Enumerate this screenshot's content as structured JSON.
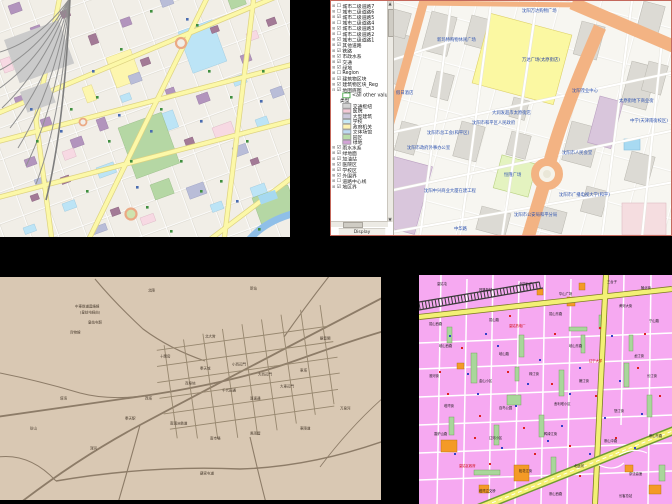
{
  "palette": {
    "desktop_background": "#000000",
    "gis_window_border": "#c4685c"
  },
  "osm_map": {
    "palette": {
      "background": "#f1eee7",
      "road_major": "#fcf8a8",
      "road_casing": "#ddd280",
      "minor_street": "#ffffff",
      "water": "#8fbfe8",
      "park": "#b5d7a4",
      "building_cyan": "#bce4f6",
      "building_purple": "#b294bd",
      "building_maroon": "#a37a96",
      "building_yellow": "#fdf6ae",
      "railway": "#909090",
      "roundabout_ring": "#eba984",
      "poi_green": "#3f8f3f",
      "poi_blue": "#4a6cb0"
    }
  },
  "gis_window": {
    "toc": {
      "layers_top": [
        {
          "e": "⊞",
          "b": "☐",
          "label": "城市二级道路7"
        },
        {
          "e": "⊞",
          "b": "☐",
          "label": "城市二级道路6"
        },
        {
          "e": "⊞",
          "b": "☑",
          "label": "城市二级道路5"
        },
        {
          "e": "⊞",
          "b": "☐",
          "label": "城市二级道路4"
        },
        {
          "e": "⊞",
          "b": "☑",
          "label": "城市二级道路3"
        },
        {
          "e": "⊞",
          "b": "☐",
          "label": "城市二级道路2"
        },
        {
          "e": "⊞",
          "b": "☑",
          "label": "城市二级道路1"
        },
        {
          "e": "⊞",
          "b": "☑",
          "label": "其他道路"
        },
        {
          "e": "⊞",
          "b": "☑",
          "label": "铁路"
        },
        {
          "e": "⊞",
          "b": "☑",
          "label": "市政水系"
        },
        {
          "e": "⊞",
          "b": "☑",
          "label": "交通"
        },
        {
          "e": "⊞",
          "b": "☑",
          "label": "绿地"
        },
        {
          "e": "⊞",
          "b": "☐",
          "label": "Region"
        },
        {
          "e": "⊞",
          "b": "☑",
          "label": "建筑物区块"
        },
        {
          "e": "⊞",
          "b": "☑",
          "label": "建筑物区块_Reg"
        },
        {
          "e": "⊟",
          "b": "☑",
          "label": "地图底图"
        }
      ],
      "legend": {
        "all_other": "<all other values>",
        "header": "类型",
        "items": [
          {
            "color": "#d2d2d2",
            "label": "交通枢纽"
          },
          {
            "color": "#f5c9d6",
            "label": "医院"
          },
          {
            "color": "#ccc9dc",
            "label": "大型建筑"
          },
          {
            "color": "#c6e9f6",
            "label": "学校"
          },
          {
            "color": "#fdf2b3",
            "label": "政府机关"
          },
          {
            "color": "#bedaf2",
            "label": "文体场馆"
          },
          {
            "color": "#b9dcaa",
            "label": "园区"
          },
          {
            "color": "#d3a3d6",
            "label": "绿地"
          }
        ]
      },
      "layers_bottom": [
        {
          "e": "⊞",
          "b": "☑",
          "label": "雨水水系"
        },
        {
          "e": "⊞",
          "b": "☑",
          "label": "绿地面"
        },
        {
          "e": "⊞",
          "b": "☑",
          "label": "加油站"
        },
        {
          "e": "⊞",
          "b": "☑",
          "label": "医院区"
        },
        {
          "e": "⊞",
          "b": "☑",
          "label": "学校区"
        },
        {
          "e": "⊞",
          "b": "☑",
          "label": "外围界"
        },
        {
          "e": "⊞",
          "b": "☐",
          "label": "道路中心线"
        },
        {
          "e": "⊞",
          "b": "☑",
          "label": "地区界"
        }
      ],
      "tab": "Display"
    },
    "map_labels": [
      {
        "x": 128,
        "y": 8,
        "text": "沈阳万达购物广场"
      },
      {
        "x": 43,
        "y": 37,
        "text": "新玛特购物休闲广场"
      },
      {
        "x": 128,
        "y": 57,
        "text": "万达广场(太原街店)",
        "color": "#1f3a9e"
      },
      {
        "x": 2,
        "y": 90,
        "text": "假日酒店"
      },
      {
        "x": 98,
        "y": 110,
        "text": "大润发超市太原街店"
      },
      {
        "x": 225,
        "y": 98,
        "text": "太原街地下商业街"
      },
      {
        "x": 33,
        "y": 130,
        "text": "沈阳市总工会(和平区)"
      },
      {
        "x": 13,
        "y": 145,
        "text": "沈阳市政府外事办公室"
      },
      {
        "x": 78,
        "y": 120,
        "text": "沈阳市和平区人民政府"
      },
      {
        "x": 110,
        "y": 172,
        "text": "恒隆广场"
      },
      {
        "x": 168,
        "y": 150,
        "text": "沈阳市人民会堂"
      },
      {
        "x": 178,
        "y": 88,
        "text": "沈阳茂业中心"
      },
      {
        "x": 236,
        "y": 118,
        "text": "中学(天津南街校区)"
      },
      {
        "x": 165,
        "y": 192,
        "text": "沈阳市广播电视大学(和平)"
      },
      {
        "x": 120,
        "y": 212,
        "text": "沈阳市公安局和平分局"
      },
      {
        "x": 30,
        "y": 188,
        "text": "沈阳中兴商业大厦在建工程"
      },
      {
        "x": 60,
        "y": 226,
        "text": "中华路"
      }
    ]
  },
  "antique_map": {
    "palette": {
      "background": "#d9c8b3",
      "road": "#8d7c68",
      "text": "#46392c"
    },
    "labels": [
      {
        "x": 88,
        "y": 44,
        "text": "皇姑屯駅"
      },
      {
        "x": 70,
        "y": 54,
        "text": "貨物線"
      },
      {
        "x": 75,
        "y": 28,
        "text": "中東鉄道連絡線"
      },
      {
        "x": 80,
        "y": 34,
        "text": "(皇姑屯経由)"
      },
      {
        "x": 148,
        "y": 12,
        "text": "北陵"
      },
      {
        "x": 250,
        "y": 10,
        "text": "新站"
      },
      {
        "x": 205,
        "y": 58,
        "text": "北大営"
      },
      {
        "x": 160,
        "y": 78,
        "text": "十間房"
      },
      {
        "x": 200,
        "y": 90,
        "text": "奉天城"
      },
      {
        "x": 232,
        "y": 86,
        "text": "小西辺門"
      },
      {
        "x": 258,
        "y": 96,
        "text": "大西辺門"
      },
      {
        "x": 185,
        "y": 105,
        "text": "商埠地"
      },
      {
        "x": 222,
        "y": 112,
        "text": "千代田通"
      },
      {
        "x": 250,
        "y": 120,
        "text": "浪速通"
      },
      {
        "x": 280,
        "y": 108,
        "text": "大東辺門"
      },
      {
        "x": 300,
        "y": 92,
        "text": "東塔"
      },
      {
        "x": 145,
        "y": 120,
        "text": "西塔"
      },
      {
        "x": 125,
        "y": 140,
        "text": "奉天駅"
      },
      {
        "x": 170,
        "y": 145,
        "text": "南満洲鉄道"
      },
      {
        "x": 210,
        "y": 160,
        "text": "南市場"
      },
      {
        "x": 250,
        "y": 155,
        "text": "風雨壇"
      },
      {
        "x": 300,
        "y": 150,
        "text": "東陵道"
      },
      {
        "x": 60,
        "y": 120,
        "text": "塔湾"
      },
      {
        "x": 30,
        "y": 150,
        "text": "砂山"
      },
      {
        "x": 90,
        "y": 170,
        "text": "渾河"
      },
      {
        "x": 200,
        "y": 195,
        "text": "蘇家屯道"
      },
      {
        "x": 320,
        "y": 60,
        "text": "観音閣"
      },
      {
        "x": 340,
        "y": 130,
        "text": "万泉河"
      }
    ]
  },
  "pink_map": {
    "palette": {
      "background": "#f6a9f1",
      "road_yellow": "#f3f075",
      "road_casing": "#7e7e22",
      "highway_edge": "#6f9c30",
      "street_white": "#ffffff",
      "green_block": "#a9d69b",
      "building_orange": "#f49a26",
      "railway": "#3a3a3a"
    },
    "labels": [
      {
        "x": 18,
        "y": 8,
        "text": "皇姑屯"
      },
      {
        "x": 60,
        "y": 14,
        "text": "铁路新村"
      },
      {
        "x": 100,
        "y": 8,
        "text": "北四台子"
      },
      {
        "x": 140,
        "y": 18,
        "text": "华山广场"
      },
      {
        "x": 188,
        "y": 6,
        "text": "三台子"
      },
      {
        "x": 222,
        "y": 12,
        "text": "陵北街"
      },
      {
        "x": 10,
        "y": 48,
        "text": "昆山西路"
      },
      {
        "x": 70,
        "y": 44,
        "text": "昆山路"
      },
      {
        "x": 130,
        "y": 38,
        "text": "昆山东路"
      },
      {
        "x": 200,
        "y": 30,
        "text": "黄河大街"
      },
      {
        "x": 230,
        "y": 45,
        "text": "宁山路"
      },
      {
        "x": 20,
        "y": 70,
        "text": "岐山西路"
      },
      {
        "x": 80,
        "y": 78,
        "text": "岐山路"
      },
      {
        "x": 150,
        "y": 70,
        "text": "岐山东路"
      },
      {
        "x": 215,
        "y": 80,
        "text": "龙江街"
      },
      {
        "x": 90,
        "y": 50,
        "text": "皇姑热电厂",
        "color": "#cc0000"
      },
      {
        "x": 170,
        "y": 85,
        "text": "辽宁大学",
        "color": "#cc0000"
      },
      {
        "x": 10,
        "y": 100,
        "text": "淮河街"
      },
      {
        "x": 60,
        "y": 105,
        "text": "金山小区"
      },
      {
        "x": 110,
        "y": 98,
        "text": "珠江街"
      },
      {
        "x": 160,
        "y": 105,
        "text": "嫩江街"
      },
      {
        "x": 228,
        "y": 100,
        "text": "长江街"
      },
      {
        "x": 25,
        "y": 130,
        "text": "塔湾街"
      },
      {
        "x": 80,
        "y": 132,
        "text": "百鸟公园"
      },
      {
        "x": 135,
        "y": 128,
        "text": "舍利塔小区"
      },
      {
        "x": 195,
        "y": 135,
        "text": "怒江街"
      },
      {
        "x": 15,
        "y": 158,
        "text": "香炉山路"
      },
      {
        "x": 70,
        "y": 162,
        "text": "辽河小区"
      },
      {
        "x": 125,
        "y": 158,
        "text": "鸭绿江街"
      },
      {
        "x": 185,
        "y": 165,
        "text": "崇山中路"
      },
      {
        "x": 230,
        "y": 160,
        "text": "崇山东路"
      },
      {
        "x": 40,
        "y": 190,
        "text": "皇姑区政府",
        "color": "#cc0000"
      },
      {
        "x": 100,
        "y": 195,
        "text": "松花江街"
      },
      {
        "x": 155,
        "y": 190,
        "text": "北运河"
      },
      {
        "x": 210,
        "y": 198,
        "text": "京沈高速"
      },
      {
        "x": 60,
        "y": 215,
        "text": "塔湾立交桥"
      },
      {
        "x": 130,
        "y": 218,
        "text": "崇山西路"
      },
      {
        "x": 200,
        "y": 220,
        "text": "长客总站"
      }
    ]
  }
}
